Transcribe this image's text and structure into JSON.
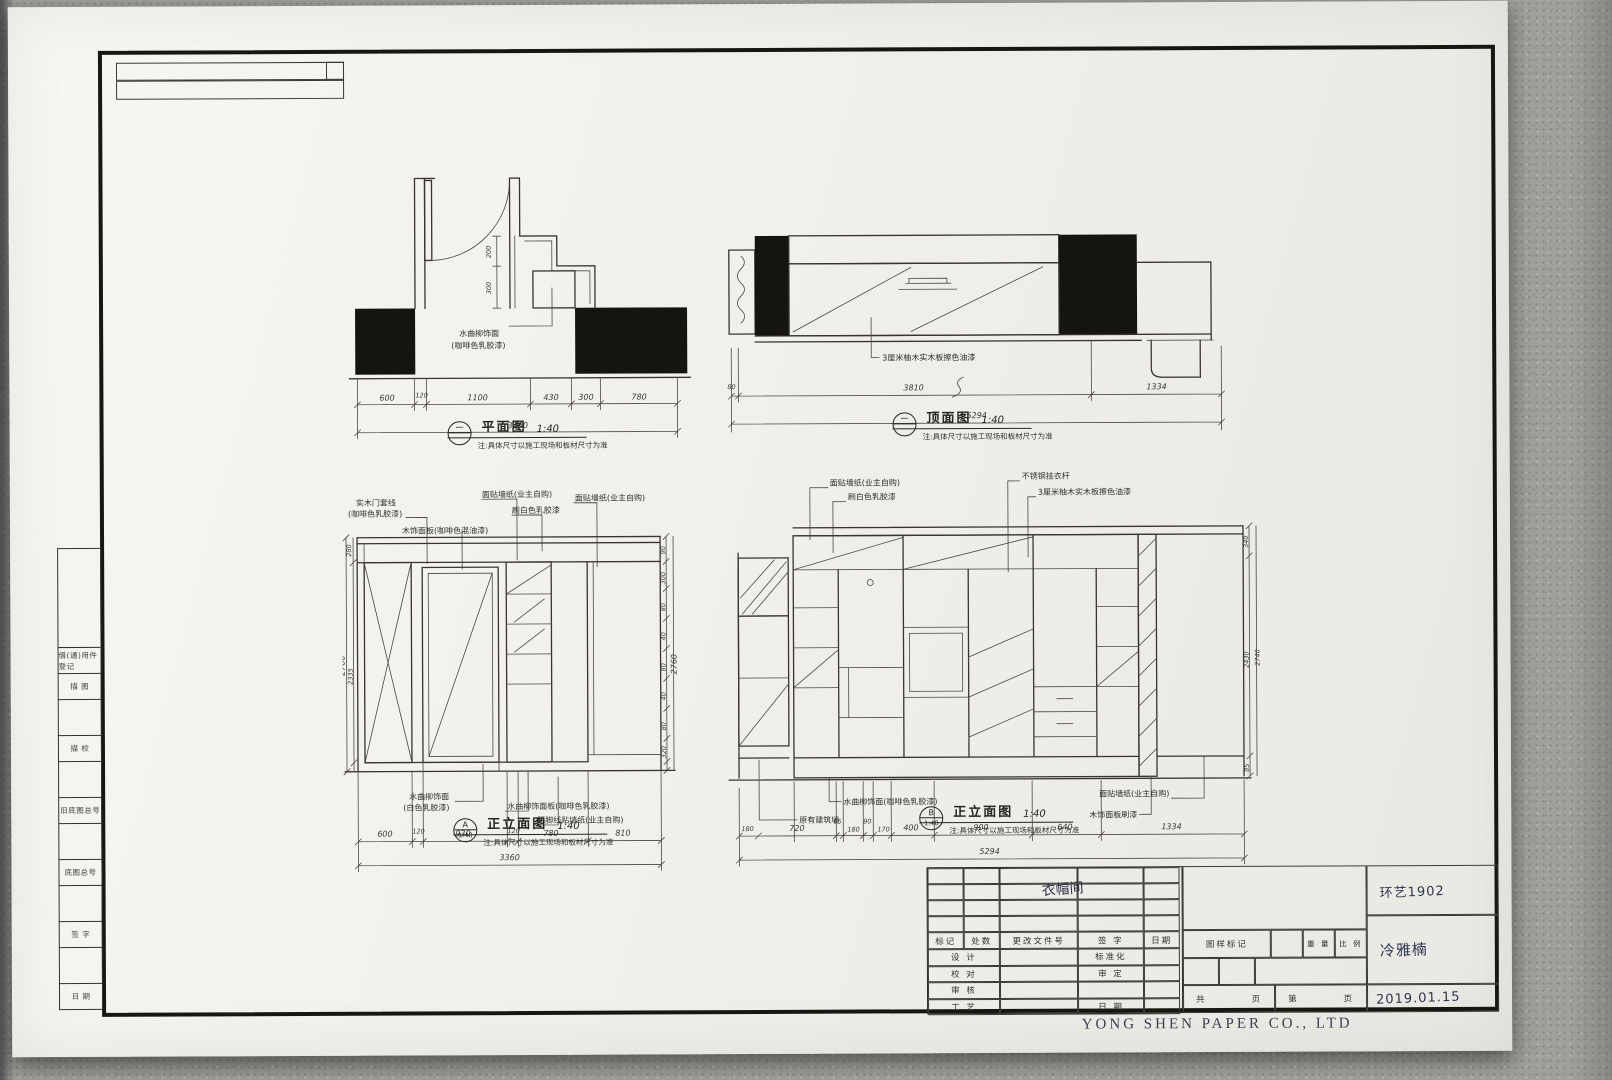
{
  "sheet": {
    "company": "YONG SHEN PAPER CO., LTD",
    "margin_labels": [
      "借(通)用件登记",
      "描  图",
      "描  校",
      "旧底图总号",
      "底图总号",
      "签  字",
      "日  期"
    ]
  },
  "captions": {
    "note": "注:具体尺寸以施工现场和板材尺寸为准",
    "plan": {
      "bubble_top": "一",
      "bubble_bottom": "",
      "title": "平面图",
      "scale": "1:40"
    },
    "ceiling": {
      "bubble_top": "一",
      "bubble_bottom": "",
      "title": "顶面图",
      "scale": "1:40"
    },
    "elev_a": {
      "bubble_top": "A",
      "bubble_bottom": "1:40",
      "title": "正立面图",
      "scale": "1:40"
    },
    "elev_b": {
      "bubble_top": "B",
      "bubble_bottom": "1:40",
      "title": "正立面图",
      "scale": "1:40"
    }
  },
  "plan": {
    "label1": "水曲柳饰面",
    "label2": "(咖啡色乳胶漆)",
    "vdims": [
      "200",
      "300"
    ],
    "dims": [
      "600",
      "120",
      "1100",
      "430",
      "300",
      "780"
    ],
    "total": "3360"
  },
  "ceiling": {
    "label": "3厘米柚木实木板擦色油漆",
    "dims": [
      "80",
      "3810",
      "1334"
    ],
    "total": "5294"
  },
  "elev_a": {
    "top_labels": [
      "实木门套线",
      "(咖啡色乳胶漆)",
      "木饰面板(咖啡色混油漆)",
      "面贴墙纸(业主自购)",
      "刷白色乳胶漆",
      "面贴墙纸(业主自购)"
    ],
    "bottom_labels": [
      "水曲柳饰面",
      "(白色乳胶漆)",
      "水曲柳饰面板(咖啡色乳胶漆)",
      "踢脚线贴墙纸(业主自购)"
    ],
    "dims": [
      "600",
      "120",
      "930",
      "120",
      "780",
      "810"
    ],
    "total": "3360",
    "left_vdims": [
      "280",
      "2335",
      "85"
    ],
    "left_total": "2700",
    "right_vdims": [
      "90",
      "300",
      "80",
      "40",
      "80",
      "40",
      "80",
      "320"
    ],
    "right_total": "2760"
  },
  "elev_b": {
    "top_labels": [
      "面贴墙纸(业主自购)",
      "刷白色乳胶漆",
      "不锈钢挂衣杆",
      "3厘米柚木实木板擦色油漆"
    ],
    "bottom_labels": [
      "水曲柳饰面(咖啡色乳胶漆)",
      "原有建筑墙",
      "面贴墙纸(业主自购)",
      "木饰面板刷漆"
    ],
    "dims": [
      "180",
      "720",
      "65",
      "180",
      "90",
      "170",
      "400",
      "900",
      "640",
      "1334"
    ],
    "total": "5294",
    "right_vdims": [
      "340",
      "2430",
      "85"
    ],
    "right_total": "2740"
  },
  "title_block": {
    "header_row": [
      "标记",
      "处数",
      "更改文件号",
      "签  字",
      "日期"
    ],
    "rows": [
      [
        "设  计",
        "标准化"
      ],
      [
        "校  对",
        "审  定"
      ],
      [
        "审  核",
        ""
      ],
      [
        "工  艺",
        "日  期"
      ]
    ],
    "drawing_mark": "图样标记",
    "weight": "重 量",
    "scale": "比 例",
    "pages": {
      "total_label": "共",
      "page_label": "页",
      "no_label": "第",
      "page_label2": "页"
    },
    "handwritten": {
      "room": "衣帽间",
      "class_no": "环艺1902",
      "author": "冷雅楠",
      "date": "2019.01.15"
    }
  }
}
